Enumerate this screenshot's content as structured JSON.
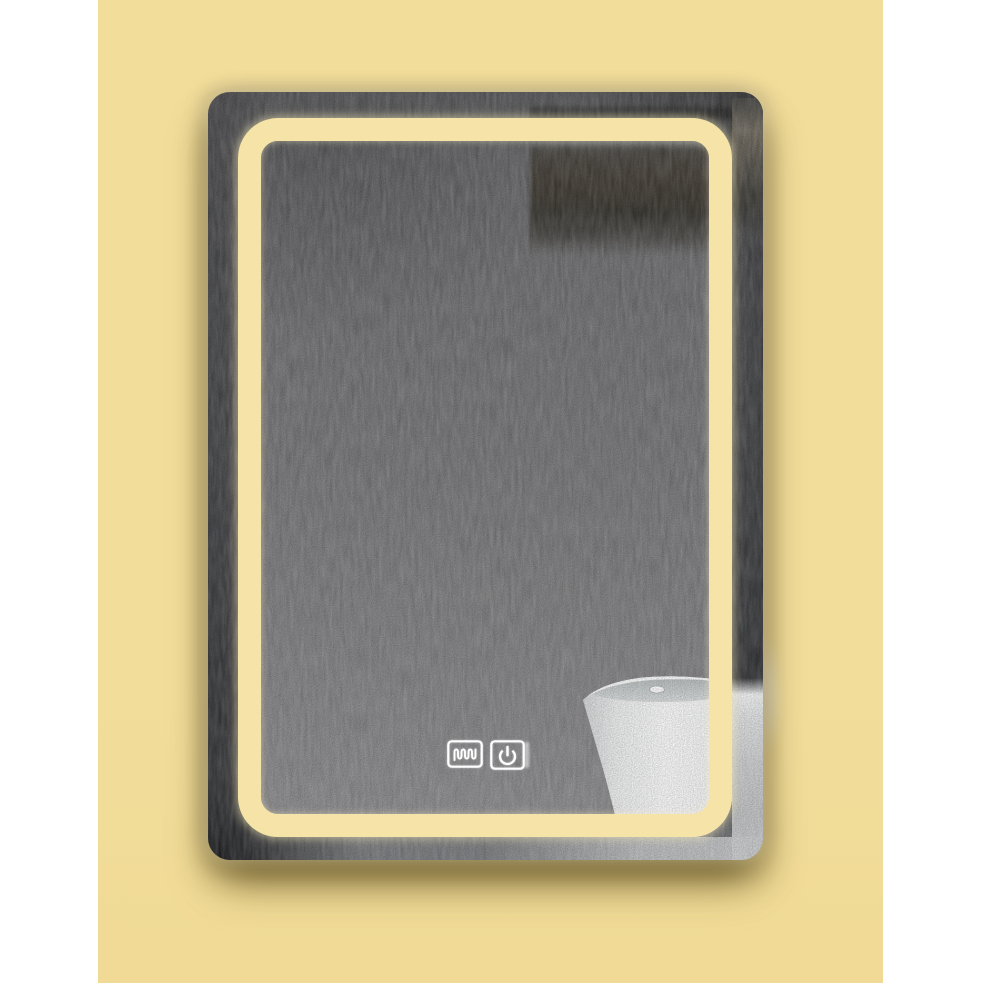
{
  "scene": {
    "title": "LED bathroom mirror product photo",
    "wall": "warm yellow painted wall with white border margins",
    "mirror": "rectangular wall mirror with rounded corners and warm LED backlit inner border",
    "reflection": {
      "background": "gray textured plaster wall",
      "shelf": "dark floating shelf reflected in upper right",
      "basin": "white freestanding pedestal basin reflected in lower right"
    }
  },
  "touch_controls": [
    {
      "name": "defogger-button",
      "icon": "defogger-icon",
      "meaning": "anti-fog heating pad toggle",
      "glyph": "serpentine heater coil in rounded square"
    },
    {
      "name": "power-button",
      "icon": "power-icon",
      "meaning": "LED light power on/off",
      "glyph": "power symbol in rounded square"
    }
  ],
  "colors": {
    "page-bg": "#ffffff",
    "wall-yellow": "#f2dd9b",
    "led-yellow": "#f6e3a8",
    "frame-top": "#5a5a5c",
    "frame-light": "#7b7d80",
    "panel-top": "#6a6a6c",
    "panel-mid": "#78787a",
    "panel-bottom": "#8f8f91",
    "shelf-dark": "#3a3934",
    "basin-white": "#fafbfb",
    "bowl-gray": "#ccd0d2",
    "icon-white": "#ffffff",
    "shadow-warm": "rgba(100,84,36,0.5)"
  }
}
